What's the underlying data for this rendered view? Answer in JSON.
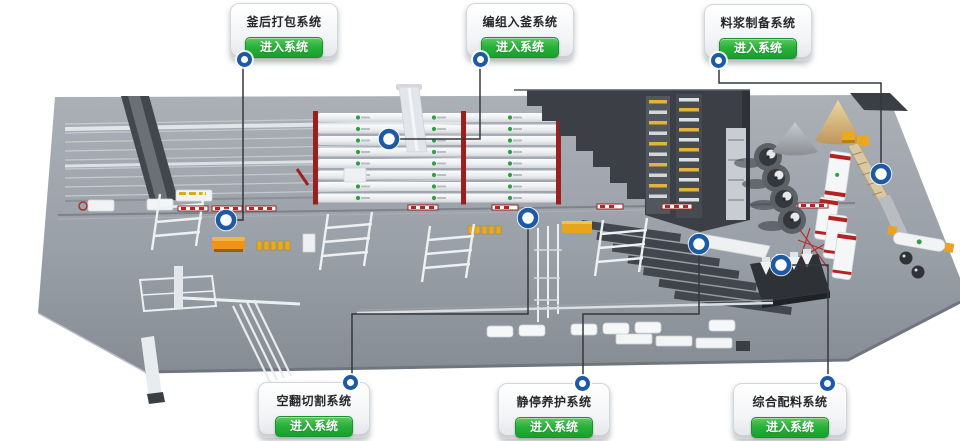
{
  "cards": [
    {
      "title": "釜后打包系统",
      "button_label": "进入系统"
    },
    {
      "title": "编组入釜系统",
      "button_label": "进入系统"
    },
    {
      "title": "料浆制备系统",
      "button_label": "进入系统"
    },
    {
      "title": "空翻切割系统",
      "button_label": "进入系统"
    },
    {
      "title": "静停养护系统",
      "button_label": "进入系统"
    },
    {
      "title": "综合配料系统",
      "button_label": "进入系统"
    }
  ],
  "icons": {
    "marker": "blue-circle-dot",
    "autoclave_brand": "green-leaf-logo"
  },
  "colors": {
    "button_green": "#2ab23c",
    "button_green_border": "#17952d",
    "marker_blue": "#1d5aa5",
    "connector_line": "#33383d",
    "platform_gray": "#9aa0a8",
    "building_dark": "#3c4046",
    "autoclave_cap_red": "#9b1f1f",
    "sand_tan": "#d4ac6e"
  }
}
